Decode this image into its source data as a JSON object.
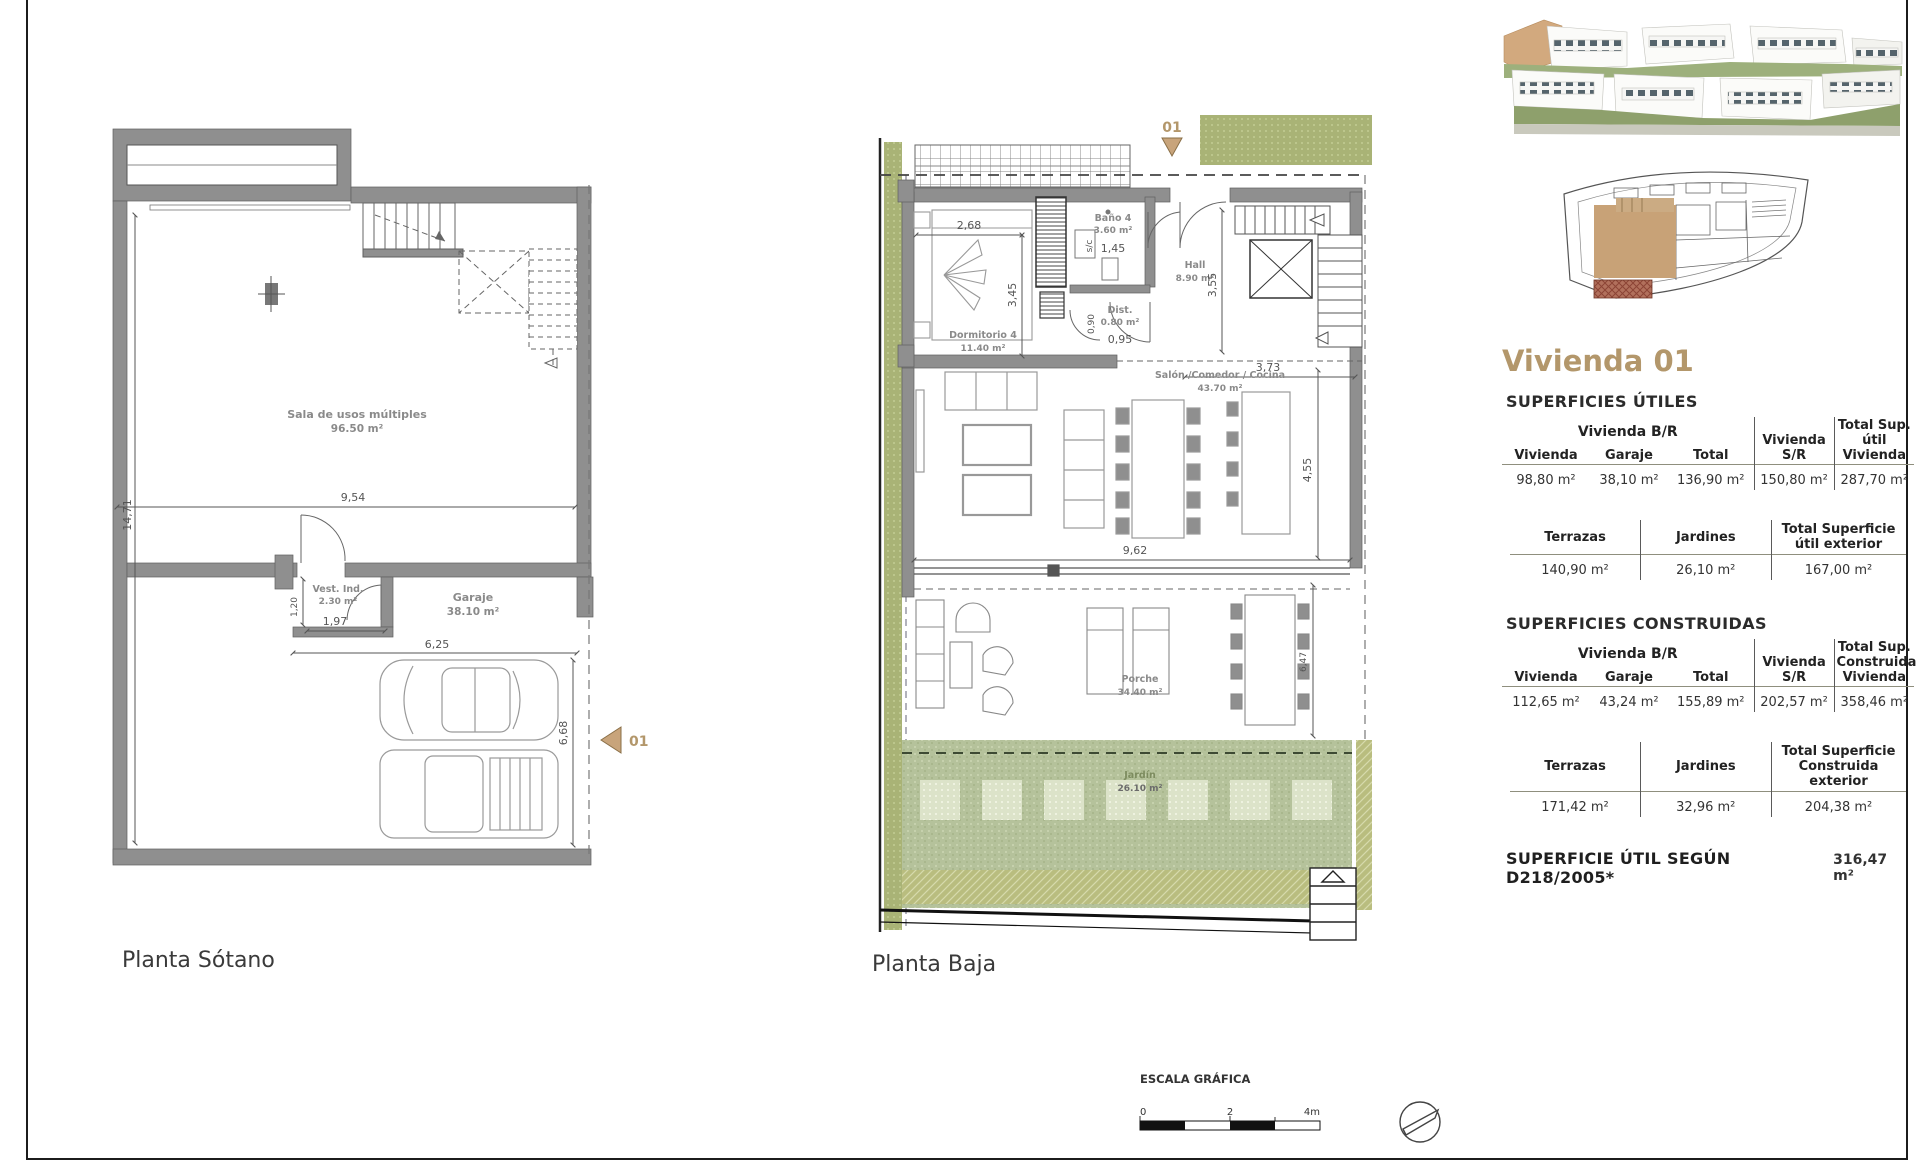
{
  "plans": {
    "sotano": {
      "label": "Planta Sótano",
      "marker": "01",
      "room_sala_name": "Sala de usos múltiples",
      "room_sala_area": "96.50 m²",
      "room_vest_name": "Vest. Ind.",
      "room_vest_area": "2.30 m²",
      "room_garaje_name": "Garaje",
      "room_garaje_area": "38.10 m²",
      "dim_sala_w": "9,54",
      "dim_left_h": "14,71",
      "dim_vest_h": "1,20",
      "dim_vest_w": "1,97",
      "dim_garaje_w": "6,25",
      "dim_garaje_h": "6,68"
    },
    "baja": {
      "label": "Planta Baja",
      "marker": "01",
      "room_dorm_name": "Dormitorio 4",
      "room_dorm_area": "11.40 m²",
      "room_bano_name": "Baño 4",
      "room_bano_area": "3.60 m²",
      "label_sc": "s/c",
      "room_hall_name": "Hall",
      "room_hall_area": "8.90 m²",
      "room_dist_name": "Dist.",
      "room_dist_area": "0.80 m²",
      "room_salon_name": "Salón /Comedor / Cocina",
      "room_salon_area": "43.70 m²",
      "room_porche_name": "Porche",
      "room_porche_area": "34.40 m²",
      "room_jardin_name": "Jardín",
      "room_jardin_area": "26.10 m²",
      "dim_dorm_w": "2,68",
      "dim_dorm_h": "3,45",
      "dim_bano_w": "1,45",
      "dim_hall_h": "3,55",
      "dim_dist_h": "0,90",
      "dim_dist_w": "0,95",
      "dim_stair_w": "3,73",
      "dim_salon_w": "9,62",
      "dim_salon_h": "4,55",
      "dim_porche_h": "6,47"
    }
  },
  "panel": {
    "title": "Vivienda 01",
    "utiles": {
      "heading": "SUPERFICIES ÚTILES",
      "group_header": "Vivienda B/R",
      "col_sr": "Vivienda S/R",
      "col_total": "Total Sup. útil Vivienda",
      "sub_cols": [
        "Vivienda",
        "Garaje",
        "Total"
      ],
      "values": [
        "98,80 m²",
        "38,10 m²",
        "136,90 m²",
        "150,80 m²",
        "287,70 m²"
      ],
      "ext_cols": [
        "Terrazas",
        "Jardines",
        "Total Superficie útil exterior"
      ],
      "ext_values": [
        "140,90 m²",
        "26,10 m²",
        "167,00 m²"
      ]
    },
    "construidas": {
      "heading": "SUPERFICIES CONSTRUIDAS",
      "group_header": "Vivienda B/R",
      "col_sr": "Vivienda S/R",
      "col_total": "Total Sup. Construida Vivienda",
      "sub_cols": [
        "Vivienda",
        "Garaje",
        "Total"
      ],
      "values": [
        "112,65 m²",
        "43,24 m²",
        "155,89 m²",
        "202,57 m²",
        "358,46 m²"
      ],
      "ext_cols": [
        "Terrazas",
        "Jardines",
        "Total Superficie Construida exterior"
      ],
      "ext_values": [
        "171,42 m²",
        "32,96 m²",
        "204,38 m²"
      ]
    },
    "footnote_label": "SUPERFICIE ÚTIL SEGÚN D218/2005*",
    "footnote_value": "316,47 m²"
  },
  "footer": {
    "escala_label": "ESCALA GRÁFICA",
    "tick0": "0",
    "tick2": "2",
    "tick4": "4m"
  },
  "colors": {
    "accent_tan": "#b3976b",
    "marker_tan": "#c8a47b",
    "garden_green": "#b5c29b",
    "strip_olive": "#a9b376",
    "wall_gray": "#8f8f8f"
  }
}
